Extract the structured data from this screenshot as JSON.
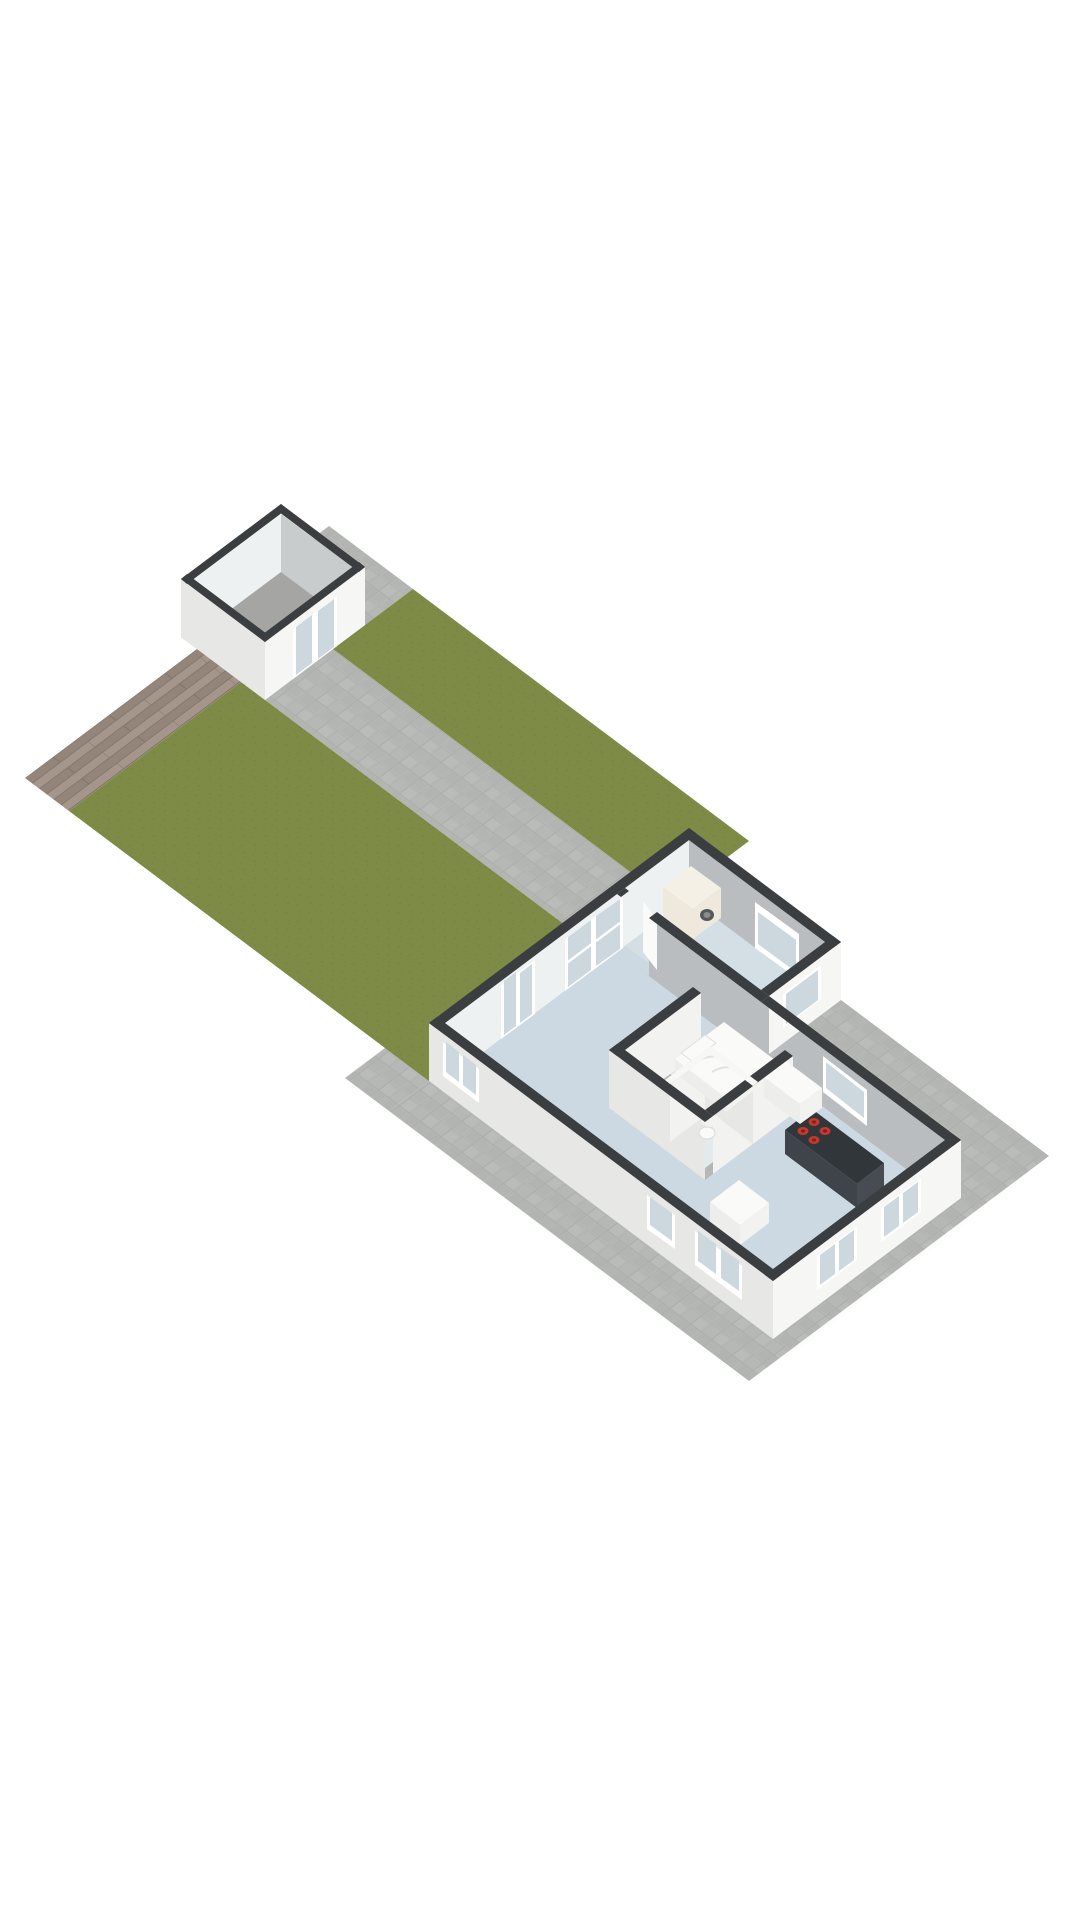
{
  "scene": {
    "kind": "3d-floorplan-render",
    "view": "isometric-overview",
    "description": "Ground plot with lawn, paved terrace, wooden deck, detached shed and a one-level dwelling"
  },
  "plot": {
    "areas": [
      {
        "name": "wood-deck",
        "surface": "wood planks"
      },
      {
        "name": "lawn",
        "surface": "grass"
      },
      {
        "name": "lawn-strip-northeast",
        "surface": "grass"
      },
      {
        "name": "paved-terrace",
        "surface": "stone tiles"
      }
    ]
  },
  "shed": {
    "name": "garden-shed",
    "walls": "white with dark top caps",
    "floor": "concrete gray",
    "door": {
      "name": "double-glass-door",
      "panels": 2
    }
  },
  "house": {
    "rooms": [
      {
        "name": "living-room",
        "floor": "light-blue",
        "openings": [
          "glass-door-nw",
          "window-nw"
        ]
      },
      {
        "name": "kitchen",
        "floor": "light-blue",
        "furniture": [
          "island-with-cooktop",
          "counter",
          "cabinet"
        ],
        "cooktop_burners": 4
      },
      {
        "name": "bedroom",
        "floor": "pale-blue",
        "furniture": [
          "bed-with-pillow-and-duvet"
        ]
      },
      {
        "name": "wc",
        "floor": "pale",
        "furniture": [
          "toilet"
        ]
      },
      {
        "name": "utility-room",
        "floor": "light-blue",
        "furniture": [
          "washing-machine"
        ]
      }
    ],
    "windows": [
      "sw-window-1",
      "sw-window-2",
      "sw-window-3",
      "se-window-1",
      "se-window-2",
      "annex-se-window",
      "kitchen-ne-window",
      "utility-ne-window"
    ]
  },
  "colors": {
    "background": "#ffffff",
    "shadow": "rgba(0,0,0,0.07)",
    "paving_base": "#b6b8b5",
    "paving_joint": "#a4a6a3",
    "paving_tile_a": "#aeb1ae",
    "paving_tile_b": "#bdbfbc",
    "lawn_base": "#7e8b46",
    "lawn_speckle": "#74813e",
    "wood_a": "#93857a",
    "wood_b": "#a4968b",
    "wood_joint": "#7c6e62",
    "wall_bright": "#f6f6f4",
    "wall_shade": "#e7e7e5",
    "wall_inner_light": "#eef1f1",
    "wall_inner_gray": "#b9bdbf",
    "wall_inner_gray2": "#c9cccc",
    "cap_dark": "#3b3e41",
    "cap_white": "#f7f7f5",
    "floor_main": "#cdd9e2",
    "floor_utility": "#d3dee5",
    "floor_bedroom": "#dfe7eb",
    "floor_wc": "#e3eaed",
    "floor_shed": "#a5a6a4",
    "glass": "#ccd8dd",
    "frame": "#ffffff",
    "washer_body": "#efe9dd",
    "washer_top": "#f5f0e6",
    "washer_door": "#55585a",
    "island_top": "#31363a",
    "island_side": "#3f444a",
    "island_side2": "#474c52",
    "burner": "#c2392e",
    "burner_dark": "#7e201a",
    "furniture_white": "#fafaf8",
    "furniture_side": "#ededeb",
    "furniture_side2": "#f2f2f0"
  }
}
